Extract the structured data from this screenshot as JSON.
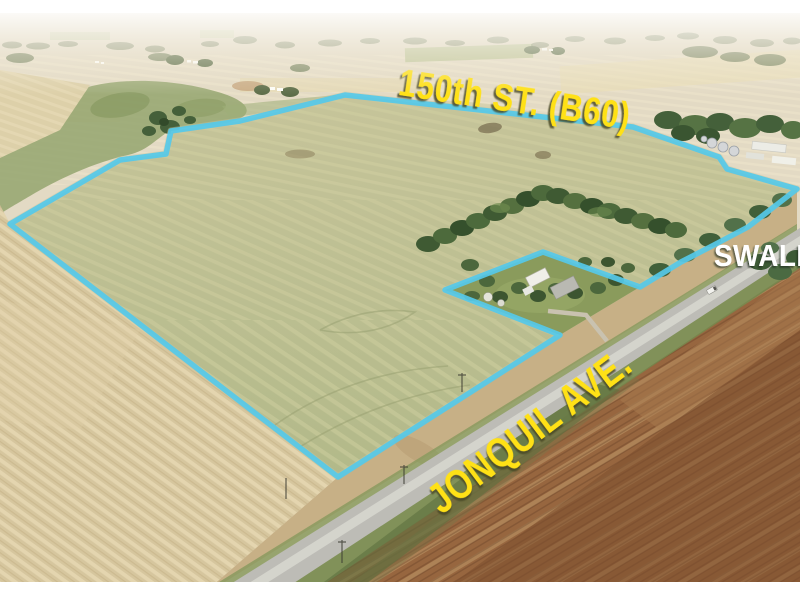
{
  "photo": {
    "labels": {
      "street_top": "150th ST. (B60)",
      "street_side": "JONQUIL AVE.",
      "feature": "SWALE"
    },
    "colors": {
      "boundary_line": "#55c9e9",
      "street_label": "#ffe112",
      "feature_label": "#ffffff"
    }
  }
}
